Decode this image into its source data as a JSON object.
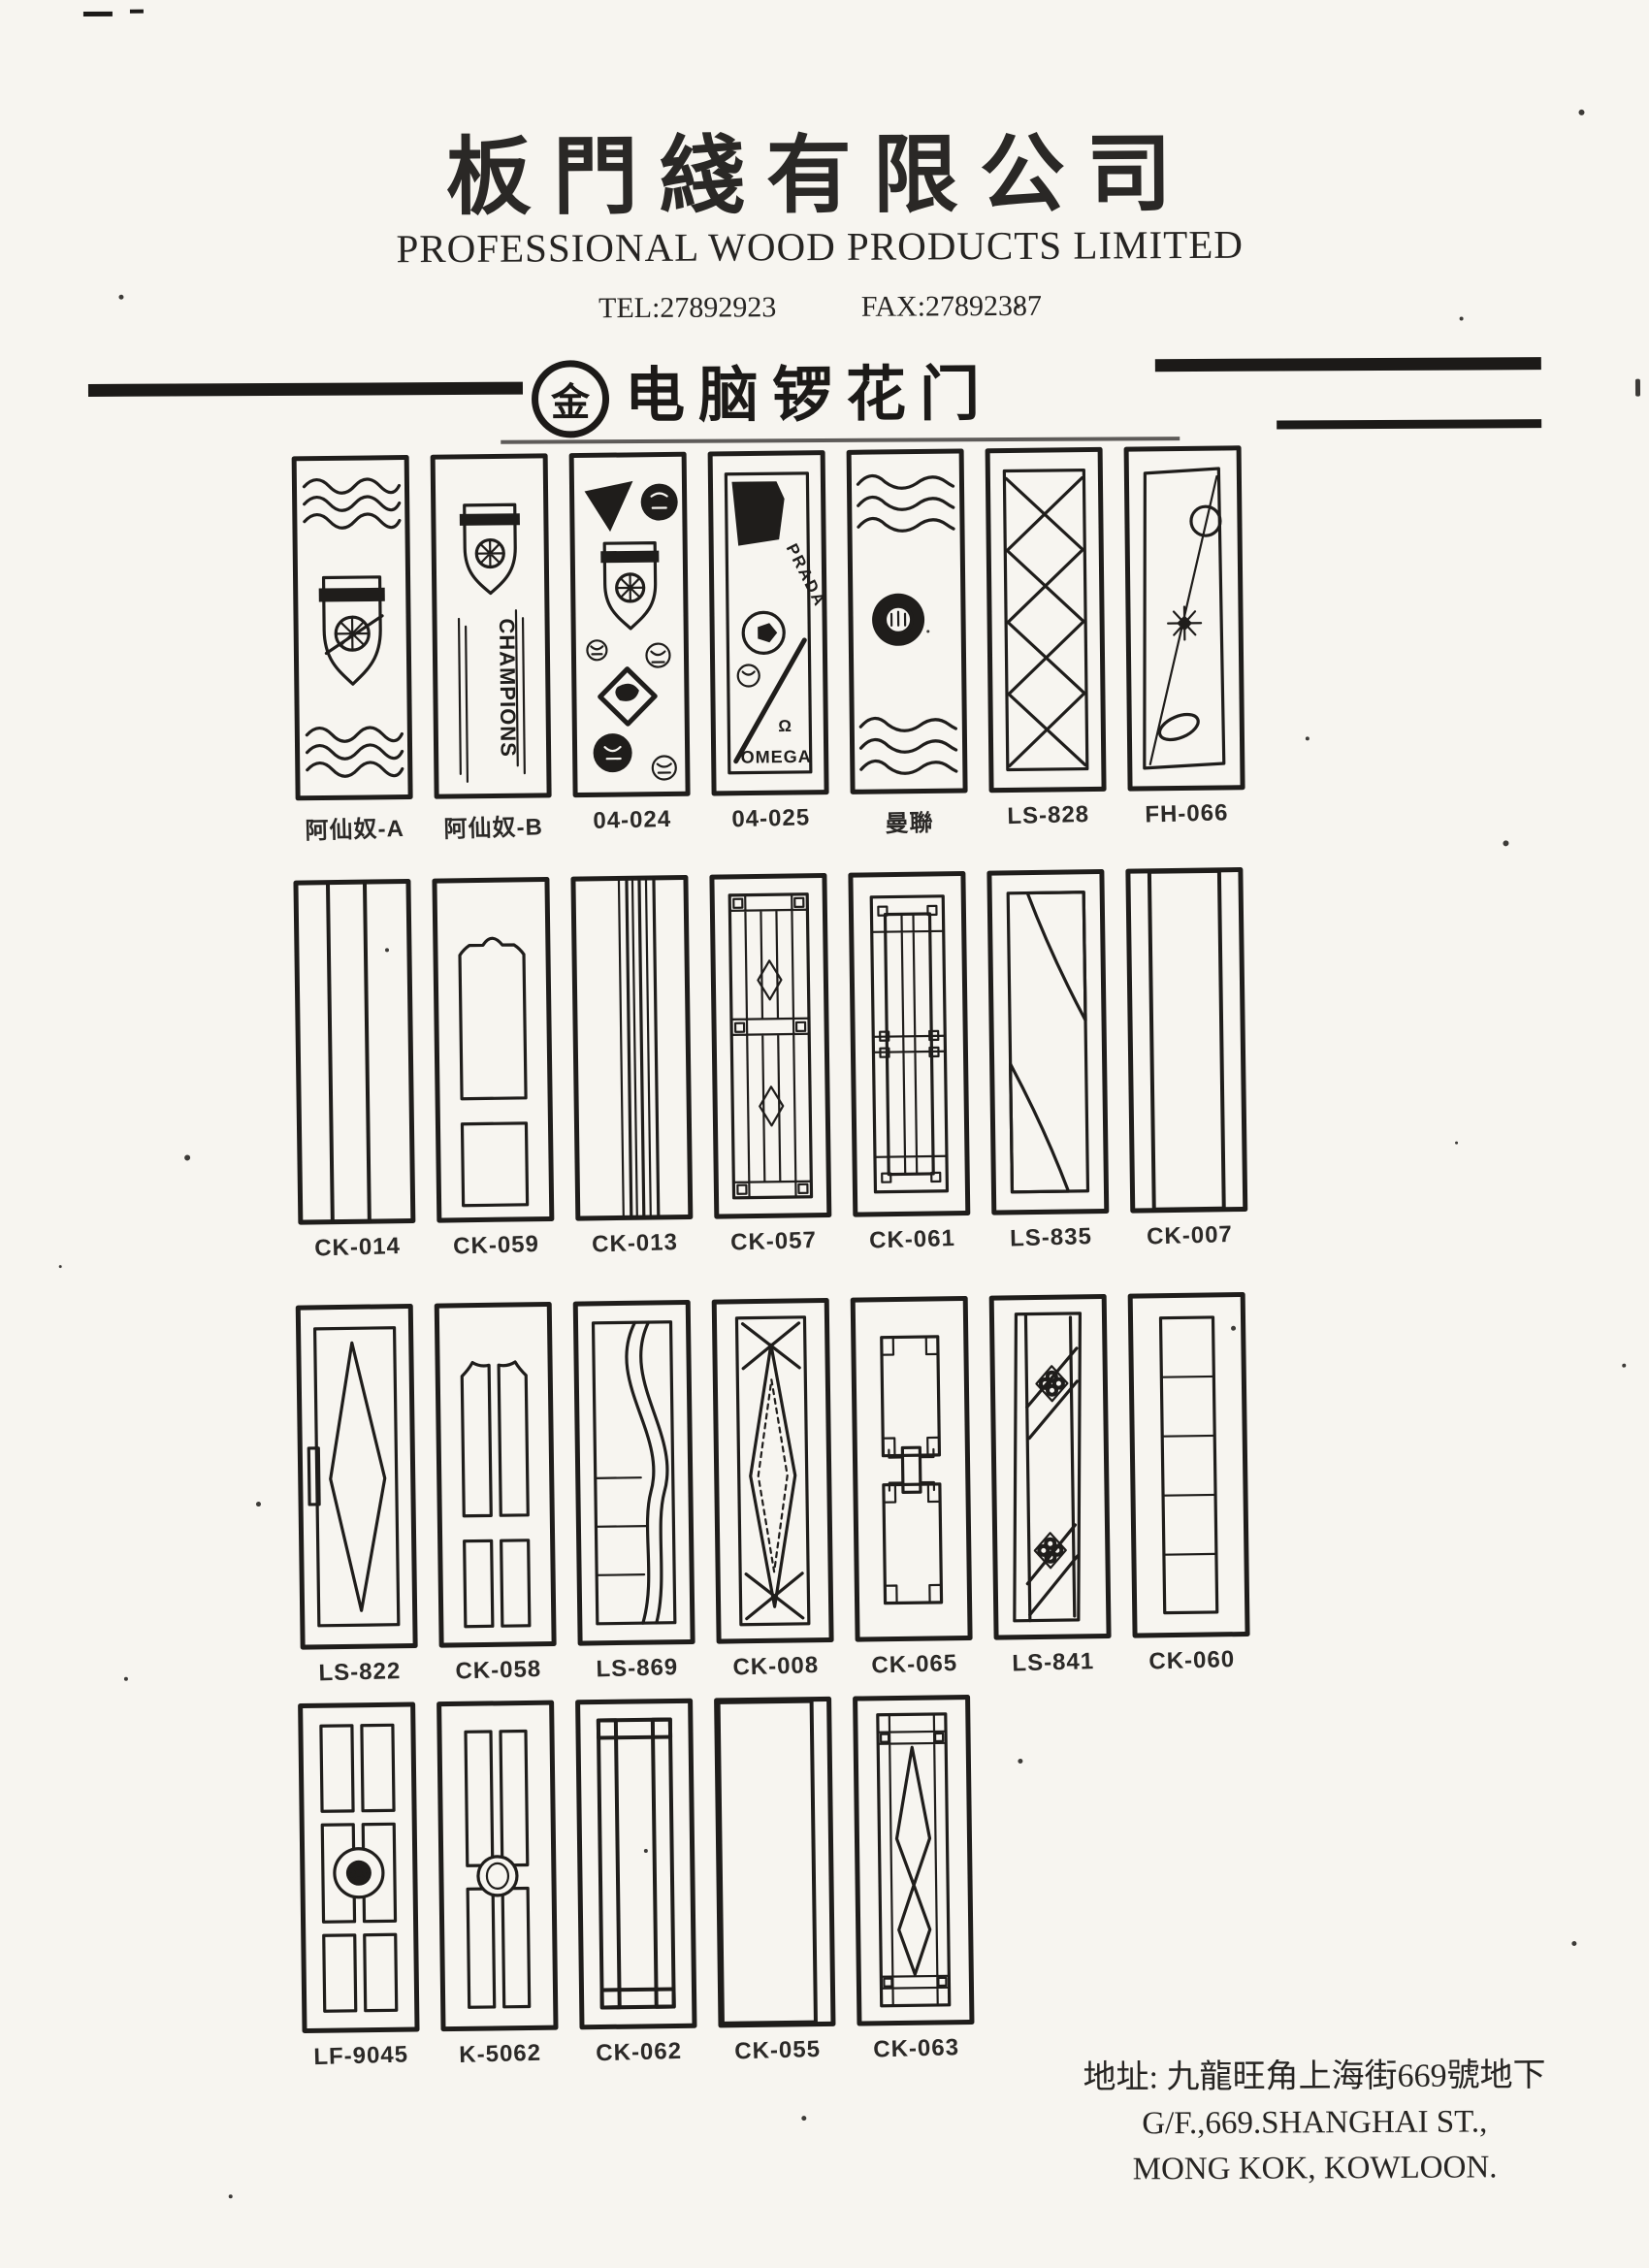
{
  "scan": {
    "paper_color": "#f7f5f0",
    "ink_color": "#1f1d1b"
  },
  "header": {
    "company_name_zh": "板門綫有限公司",
    "company_name_en": "PROFESSIONAL WOOD PRODUCTS LIMITED",
    "tel": "TEL:27892923",
    "fax": "FAX:27892387"
  },
  "banner": {
    "badge": "金",
    "title": "电脑锣花门"
  },
  "catalog": {
    "rows": [
      {
        "doors": [
          {
            "label": "阿仙奴-A",
            "design": "arsenal-crest-wave-panels"
          },
          {
            "label": "阿仙奴-B",
            "design": "arsenal-crest-champions",
            "text": "CHAMPIONS"
          },
          {
            "label": "04-024",
            "design": "football-badge-collage"
          },
          {
            "label": "04-025",
            "design": "brand-logo-collage",
            "texts": {
              "brand_top": "PRADA",
              "omega_symbol": "Ω",
              "brand_bottom": "OMEGA"
            }
          },
          {
            "label": "曼聯",
            "design": "club-emblem-wave-panels"
          },
          {
            "label": "LS-828",
            "design": "diamond-lattice-panel"
          },
          {
            "label": "FH-066",
            "design": "diagonal-circle-star-leaf"
          }
        ]
      },
      {
        "doors": [
          {
            "label": "CK-014",
            "design": "mesh-grid-strip"
          },
          {
            "label": "CK-059",
            "design": "two-panel-arched"
          },
          {
            "label": "CK-013",
            "design": "vertical-line-cluster"
          },
          {
            "label": "CK-057",
            "design": "leaded-glass-diamonds"
          },
          {
            "label": "CK-061",
            "design": "rectilinear-lattice"
          },
          {
            "label": "LS-835",
            "design": "lens-with-mesh-corners"
          },
          {
            "label": "CK-007",
            "design": "zigzag-column"
          }
        ]
      },
      {
        "doors": [
          {
            "label": "LS-822",
            "design": "hatched-long-diamond"
          },
          {
            "label": "CK-058",
            "design": "four-vertical-panels"
          },
          {
            "label": "LS-869",
            "design": "s-curve-band"
          },
          {
            "label": "CK-008",
            "design": "long-diamond-with-x"
          },
          {
            "label": "CK-065",
            "design": "notched-panels-link"
          },
          {
            "label": "LS-841",
            "design": "diagonal-bands-quatrefoils"
          },
          {
            "label": "CK-060",
            "design": "five-stacked-panels"
          }
        ]
      },
      {
        "doors": [
          {
            "label": "LF-9045",
            "design": "six-panel-center-rosette"
          },
          {
            "label": "K-5062",
            "design": "four-panel-center-ring"
          },
          {
            "label": "CK-062",
            "design": "square-chain-border"
          },
          {
            "label": "CK-055",
            "design": "full-crosshatch"
          },
          {
            "label": "CK-063",
            "design": "leaded-double-diamond"
          }
        ]
      }
    ]
  },
  "footer": {
    "address_zh": "地址: 九龍旺角上海街669號地下",
    "address_en_line1": "G/F.,669.SHANGHAI ST.,",
    "address_en_line2": "MONG KOK, KOWLOON."
  }
}
